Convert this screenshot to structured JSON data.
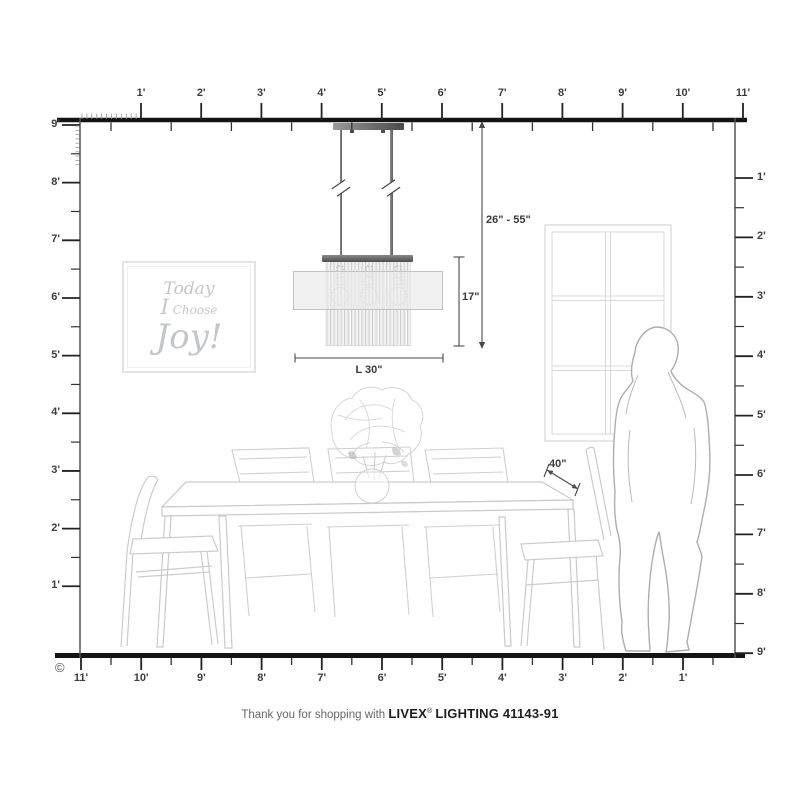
{
  "rulers": {
    "top_labels": [
      "1'",
      "2'",
      "3'",
      "4'",
      "5'",
      "6'",
      "7'",
      "8'",
      "9'",
      "10'",
      "11'"
    ],
    "bottom_labels": [
      "11'",
      "10'",
      "9'",
      "8'",
      "7'",
      "6'",
      "5'",
      "4'",
      "3'",
      "2'",
      "1'"
    ],
    "left_labels": [
      "9'",
      "8'",
      "7'",
      "6'",
      "5'",
      "4'",
      "3'",
      "2'",
      "1'"
    ],
    "right_labels": [
      "1'",
      "2'",
      "3'",
      "4'",
      "5'",
      "6'",
      "7'",
      "8'",
      "9'"
    ]
  },
  "dimensions": {
    "hang_range": "26\" - 55\"",
    "fixture_height": "17\"",
    "fixture_length": "L 30\"",
    "table_depth": "40\""
  },
  "wall_art": {
    "line1": "Today",
    "line2_word1": "I",
    "line2_word2": "Choose",
    "line3": "Joy!"
  },
  "footer": {
    "message": "Thank you for shopping with",
    "brand": "LIVEX",
    "registered": "®",
    "product": "LIGHTING 41143-91"
  },
  "copyright": "©",
  "colors": {
    "structure_line": "#1b1b1b",
    "wall_line": "#555555",
    "ruler_text": "#3c3c3c",
    "dimension_text": "#3a3a3a",
    "sketch_line": "#cccccc",
    "fixture_metal": "#5a5a5a",
    "art_text": "#c3c6c8"
  }
}
